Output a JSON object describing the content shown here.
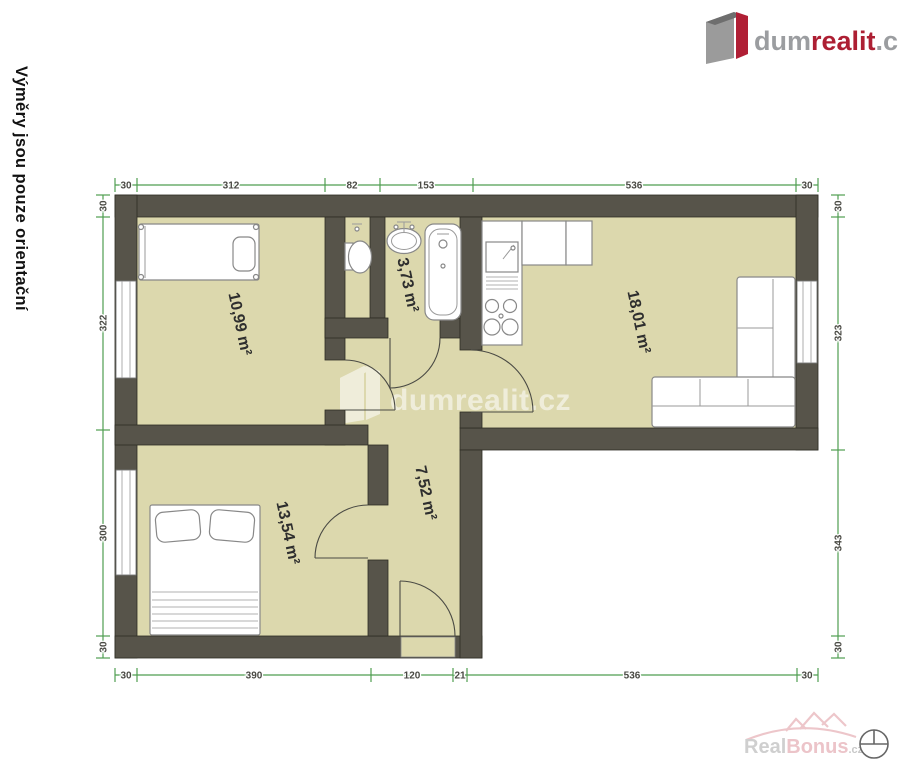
{
  "note": "Výměry jsou pouze orientační",
  "header_logo": {
    "part1": "dum",
    "part2": "realit",
    "part3": ".cz"
  },
  "watermark": "dumrealit.cz",
  "footer_logo": {
    "part1": "Real",
    "part2": "Bonus",
    "part3": ".cz"
  },
  "rooms": [
    {
      "name": "bedroom-top",
      "area": "10,99 m²"
    },
    {
      "name": "bathroom",
      "area": "3,73 m²"
    },
    {
      "name": "living-room",
      "area": "18,01 m²"
    },
    {
      "name": "bedroom-bottom",
      "area": "13,54 m²"
    },
    {
      "name": "hallway",
      "area": "7,52 m²"
    }
  ],
  "dimensions": {
    "top": [
      "30",
      "312",
      "82",
      "153",
      "536",
      "30"
    ],
    "bottom": [
      "30",
      "390",
      "120",
      "21",
      "536",
      "30"
    ],
    "left": [
      "30",
      "322",
      "300",
      "30"
    ],
    "right": [
      "30",
      "323",
      "343",
      "30"
    ]
  },
  "colors": {
    "wall": "#57544a",
    "floor": "#dcd8ad",
    "dimension_green": "#4f9e51",
    "brand_red": "#b01f35"
  }
}
